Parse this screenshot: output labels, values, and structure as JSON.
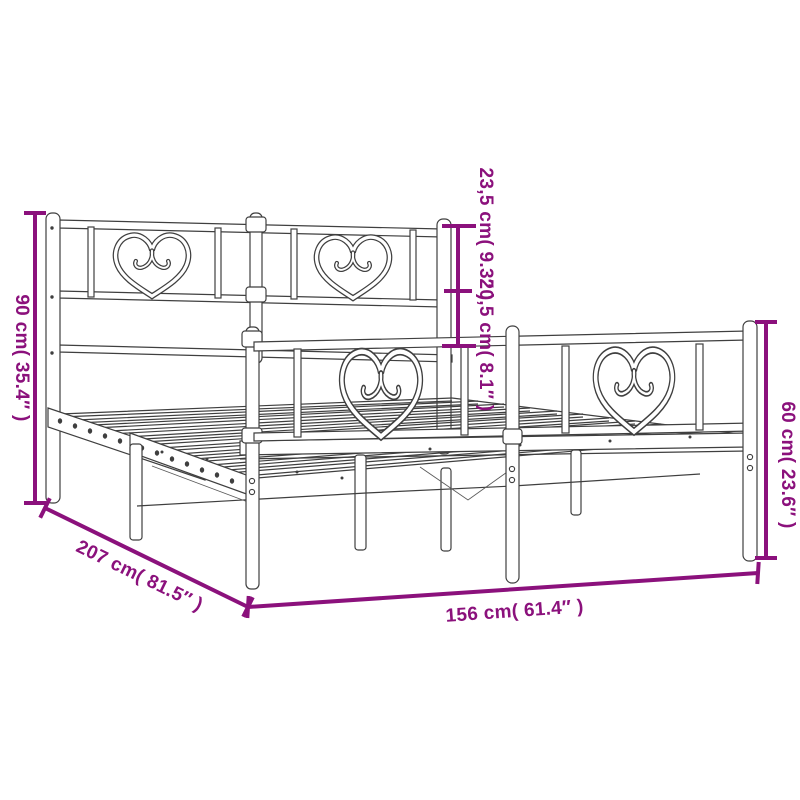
{
  "diagram": {
    "style": {
      "accent_color": "#8B117C",
      "line_color": "#3F3F3F",
      "background": "#ffffff"
    },
    "dimensions": {
      "headboard_height": "90 cm( 35.4″ )",
      "headboard_upper_panel": "23,5 cm( 9.3″ )",
      "headboard_lower_panel": "20,5 cm( 8.1″ )",
      "footboard_height": "60 cm( 23.6″ )",
      "frame_length": "207 cm( 81.5″ )",
      "frame_width": "156 cm( 61.4″ )"
    }
  }
}
